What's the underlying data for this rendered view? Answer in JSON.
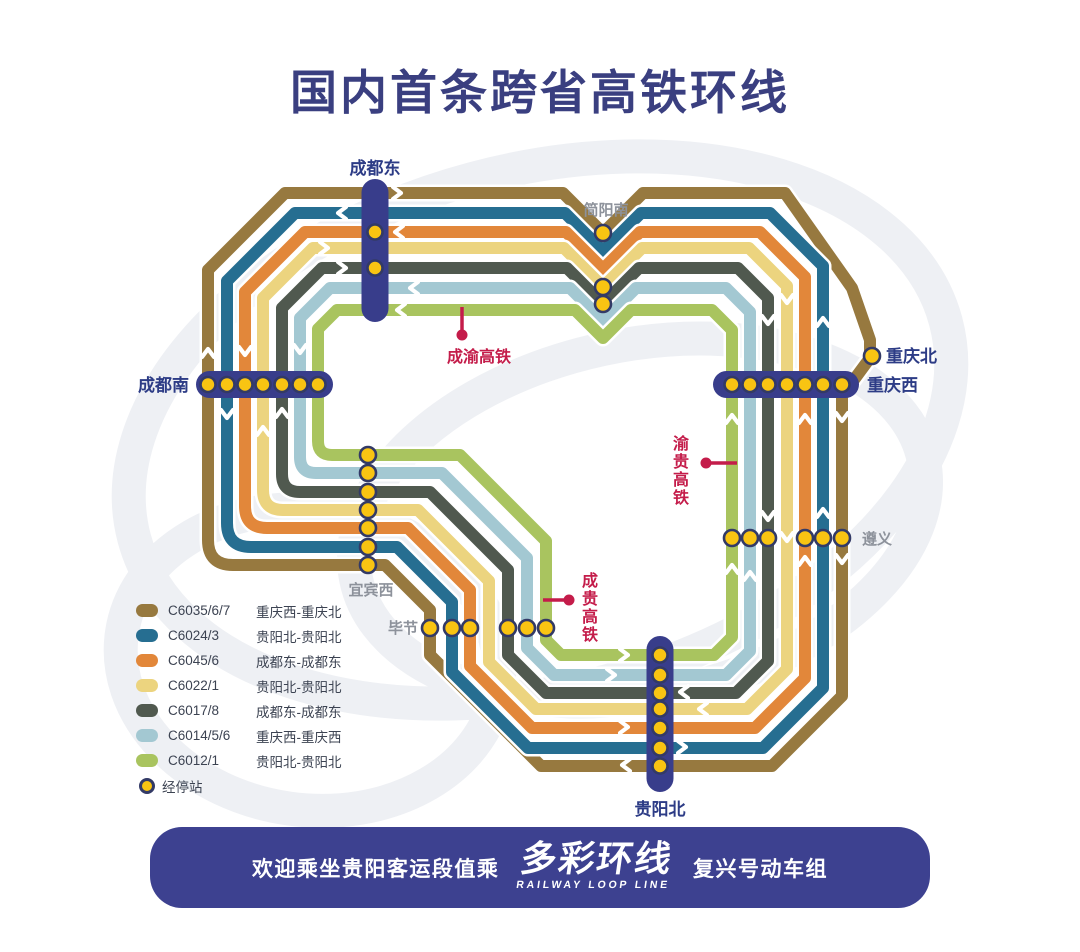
{
  "title": "国内首条跨省高铁环线",
  "colors": {
    "navy_capsule": "#383d8b",
    "label_navy": "#2d3c86",
    "label_gray": "#8d929b",
    "red": "#c41c4a",
    "dot_yellow": "#f9c412",
    "dot_ring": "#333a66",
    "banner_navy": "#3d4190",
    "title_navy": "#3a3f80",
    "chevron_white": "#ffffff"
  },
  "lines": [
    {
      "code": "C6035/6/7",
      "route": "重庆西-重庆北",
      "color": "#97793f"
    },
    {
      "code": "C6024/3",
      "route": "贵阳北-贵阳北",
      "color": "#266e91"
    },
    {
      "code": "C6045/6",
      "route": "成都东-成都东",
      "color": "#e2873a"
    },
    {
      "code": "C6022/1",
      "route": "贵阳北-贵阳北",
      "color": "#ecd47f"
    },
    {
      "code": "C6017/8",
      "route": "成都东-成都东",
      "color": "#50594f"
    },
    {
      "code": "C6014/5/6",
      "route": "重庆西-重庆西",
      "color": "#a3c8d2"
    },
    {
      "code": "C6012/1",
      "route": "贵阳北-贵阳北",
      "color": "#a9c45f"
    }
  ],
  "legend": {
    "stop_label": "经停站"
  },
  "icons": {
    "stop_dot": "yellow-circle-stop-marker",
    "chevron": "white-direction-arrow"
  },
  "map": {
    "stations": {
      "chengdudong": {
        "name": "成都东",
        "marker": "capsule-vertical",
        "dot_count": 2,
        "label_style": "terminal"
      },
      "jianyangnan": {
        "name": "简阳南",
        "marker": "dots",
        "dot_count": 3,
        "label_style": "minor"
      },
      "chongqingbei": {
        "name": "重庆北",
        "marker": "dots",
        "dot_count": 1,
        "label_style": "terminal"
      },
      "chongqingxi": {
        "name": "重庆西",
        "marker": "capsule-horizontal",
        "dot_count": 7,
        "label_style": "terminal"
      },
      "chengdunan": {
        "name": "成都南",
        "marker": "capsule-horizontal",
        "dot_count": 7,
        "label_style": "terminal"
      },
      "zunyi": {
        "name": "遵义",
        "marker": "dots",
        "dot_count": 6,
        "label_style": "minor"
      },
      "yibinxi": {
        "name": "宜宾西",
        "marker": "dots",
        "dot_count": 7,
        "label_style": "minor"
      },
      "bijie": {
        "name": "毕节",
        "marker": "dots",
        "dot_count": 6,
        "label_style": "minor"
      },
      "guiyangbei": {
        "name": "贵阳北",
        "marker": "capsule-vertical",
        "dot_count": 7,
        "label_style": "terminal"
      }
    },
    "railway_labels": {
      "chengyu": "成渝高铁",
      "yugui": "渝贵高铁",
      "chenggui": "成贵高铁"
    }
  },
  "banner": {
    "welcome": "欢迎乘坐贵阳客运段值乘",
    "brand": "多彩环线",
    "brand_en": "RAILWAY LOOP LINE",
    "trainset": "复兴号动车组"
  }
}
